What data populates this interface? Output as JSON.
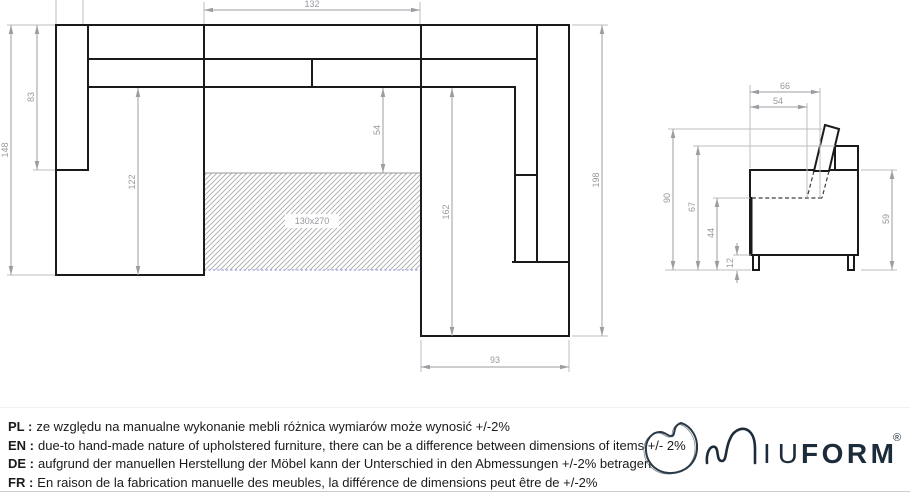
{
  "plan_view": {
    "dims": {
      "width_center": "132",
      "depth_left": "148",
      "armrest_left": "83",
      "seat_left": "122",
      "seat_center": "54",
      "seat_right": "162",
      "depth_right": "198",
      "width_right": "93",
      "sleeping_area": "130x270"
    }
  },
  "side_view": {
    "dims": {
      "depth_total": "66",
      "depth_seat": "54",
      "height_total": "90",
      "height_back": "67",
      "height_seat": "44",
      "height_legs": "12",
      "height_arm": "59"
    }
  },
  "disclaimer": {
    "rows": [
      {
        "label": "PL :",
        "text": "ze względu na manualne wykonanie mebli różnica wymiarów może wynosić +/-2%"
      },
      {
        "label": "EN :",
        "text": "due-to hand-made nature of upholstered furniture, there can be a difference between dimensions of items +/- 2%"
      },
      {
        "label": "DE :",
        "text": "aufgrund der manuellen Herstellung der Möbel kann der Unterschied in den Abmessungen +/-2% betragen"
      },
      {
        "label": "FR :",
        "text": "En raison de la fabrication manuelle des meubles, la différence de dimensions peut être de +/-2%"
      }
    ]
  },
  "logo": {
    "name_light": "IU",
    "name_bold": "FORM",
    "registered_mark": "®"
  },
  "colors": {
    "outline": "#1a1a1a",
    "dimension": "#9c9ca2",
    "hatch": "#ababaf",
    "bed_edge": "#9aa0dc",
    "divider": "#cccccc",
    "brand": "#1d2c3a"
  }
}
